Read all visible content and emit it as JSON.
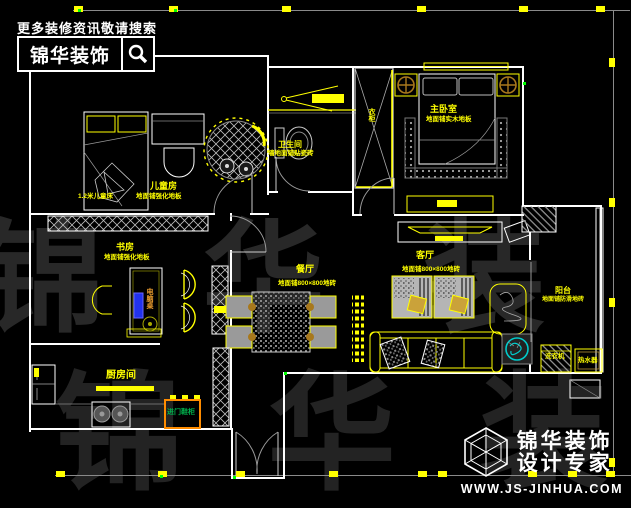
{
  "header": {
    "tagline": "更多装修资讯敬请搜索",
    "brand": "锦华装饰"
  },
  "watermark": {
    "row1": "锦 华 装 饰",
    "row2": "锦 华 装"
  },
  "rooms": {
    "children": {
      "name": "儿童房",
      "sub": "地面铺强化地板",
      "bed_note": "1.2米儿童床"
    },
    "bathroom": {
      "name": "卫生间",
      "sub": "墙地面铺贴瓷砖"
    },
    "master": {
      "name": "主卧室",
      "sub": "地面铺实木地板",
      "wardrobe": "衣柜"
    },
    "study": {
      "name": "书房",
      "sub": "地面铺强化地板",
      "desk": "电脑桌"
    },
    "dining": {
      "name": "餐厅",
      "sub": "地面铺800×800地砖"
    },
    "living": {
      "name": "客厅",
      "sub": "地面铺800×800地砖"
    },
    "balcony": {
      "name": "阳台",
      "sub": "地面铺防滑地砖",
      "washer": "洗衣机",
      "heater": "热水器"
    },
    "kitchen": {
      "name": "厨房间",
      "shoe_cabinet": "进门鞋柜"
    }
  },
  "footer": {
    "brand": "锦华装饰",
    "tagline": "设计专家",
    "url": "WWW.JS-JINHUA.COM"
  },
  "colors": {
    "accent": "#ffff00",
    "wall": "#ffffff",
    "green_label": "#00b34d",
    "orange": "#ff8c00",
    "teal": "#00cccc",
    "blue": "#2233ee"
  }
}
